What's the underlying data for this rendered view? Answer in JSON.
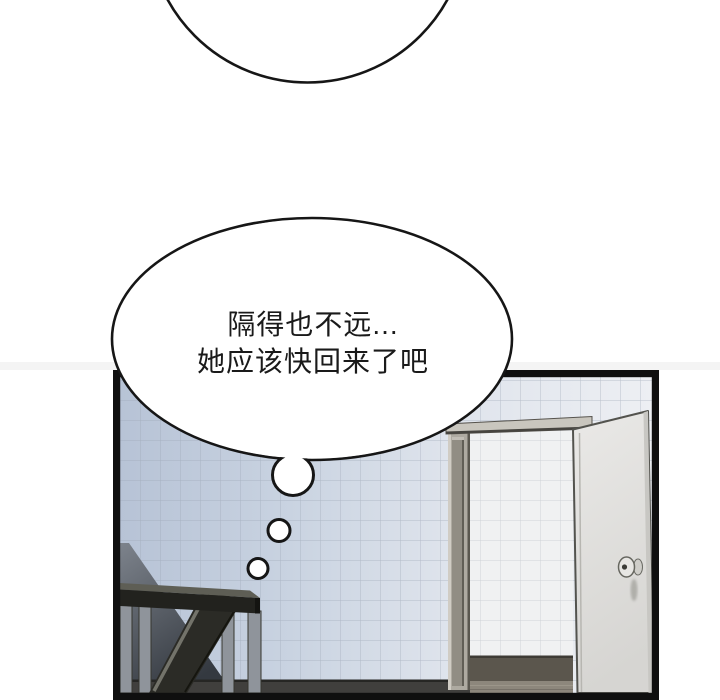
{
  "page": {
    "background_color": "#ffffff"
  },
  "thought_bubble": {
    "lines": [
      "隔得也不远...",
      "她应该快回来了吧"
    ],
    "outline_color": "#161616",
    "fill_color": "#ffffff"
  },
  "panel": {
    "border_color": "#0f0f0f",
    "wall": {
      "tile_left_color": "#c9d3e1",
      "tile_right_color": "#edeff3",
      "grout_color": "#9aa4b2"
    },
    "doorway": {
      "inner_tile_color": "#f0f1f2",
      "frame_color": "#aeaaa1",
      "baseboard_color": "#5b564d",
      "inner_floor_color": "#8d877c"
    },
    "door": {
      "color": "#e2e1de",
      "knob_color": "#e7e6e3"
    },
    "stairs": {
      "rail_color": "#22221e",
      "baluster_color": "#8f949b",
      "shadow_color": "#3a3f45"
    },
    "floor_color": "#403f3d"
  }
}
